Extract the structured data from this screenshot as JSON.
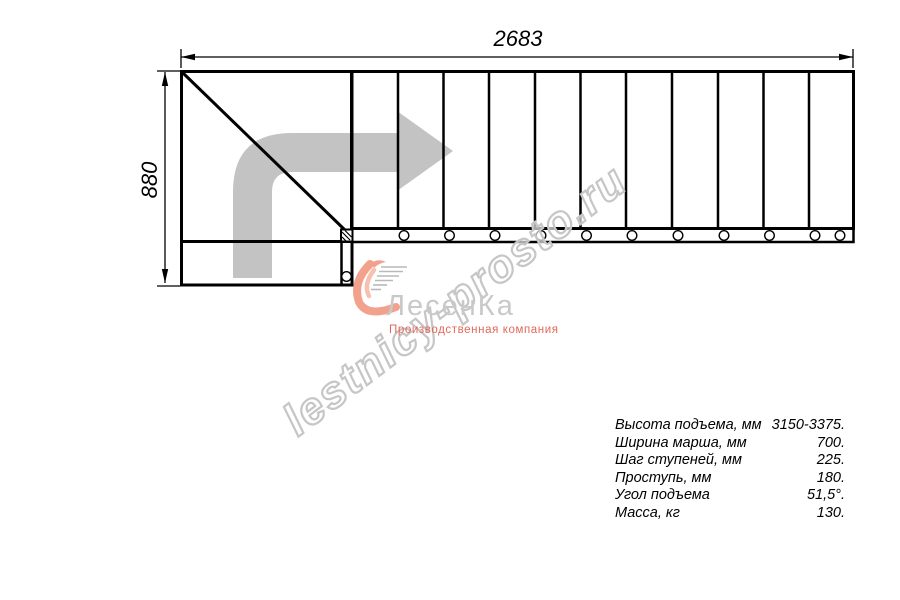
{
  "drawing": {
    "title": "stair-plan-top-view",
    "dim_width_label": "2683",
    "dim_height_label": "880",
    "treads_count": 11,
    "colors": {
      "line": "#000000",
      "direction_arrow": "#c3c3c3",
      "logo_text": "#c9c9c9",
      "logo_accent": "#f2a28c",
      "logo_subtitle": "#e2685b",
      "watermark": "#c6c6c6"
    }
  },
  "watermark": {
    "text": "lestnicy-prosto.ru"
  },
  "logo": {
    "name": "ЛесенКа",
    "subtitle": "Производственная компания"
  },
  "specs": {
    "rows": [
      {
        "label": "Высота подъема, мм",
        "value": "3150-3375."
      },
      {
        "label": "Ширина марша, мм",
        "value": "700."
      },
      {
        "label": "Шаг ступеней, мм",
        "value": "225."
      },
      {
        "label": "Проступь, мм",
        "value": "180."
      },
      {
        "label": "Угол подъема",
        "value": "51,5°."
      },
      {
        "label": "Масса, кг",
        "value": "130."
      }
    ]
  }
}
